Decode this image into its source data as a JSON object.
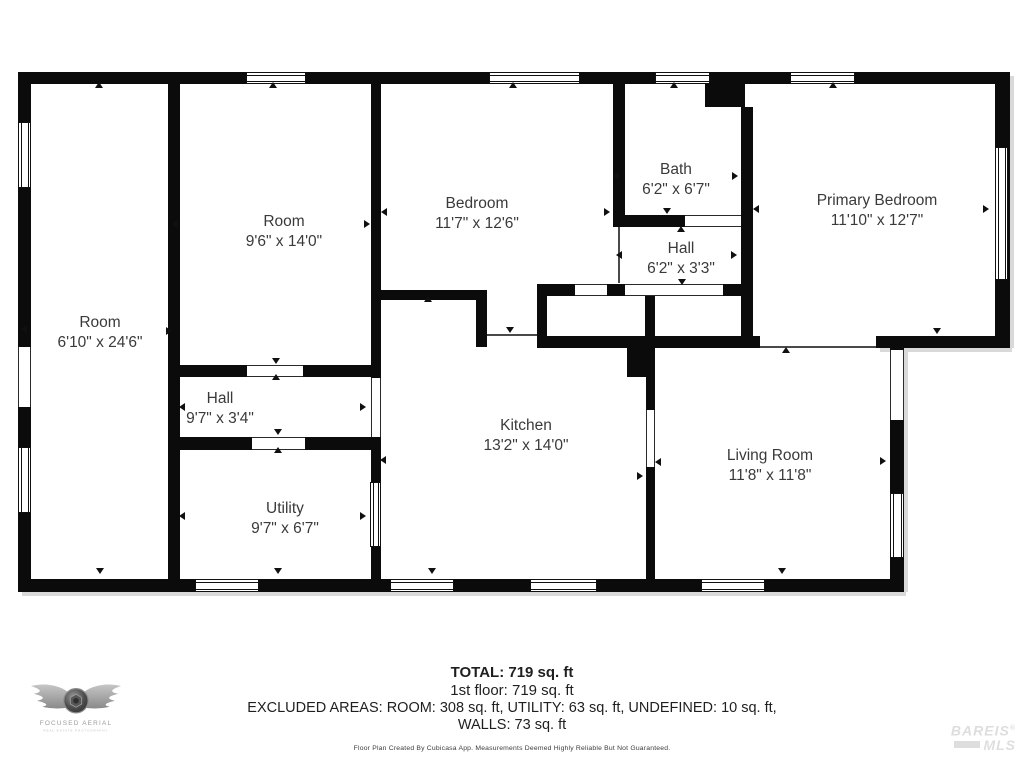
{
  "rooms": [
    {
      "name": "Room",
      "dims": "6'10\" x 24'6\""
    },
    {
      "name": "Room",
      "dims": "9'6\" x 14'0\""
    },
    {
      "name": "Bedroom",
      "dims": "11'7\" x 12'6\""
    },
    {
      "name": "Bath",
      "dims": "6'2\" x 6'7\""
    },
    {
      "name": "Hall",
      "dims": "6'2\" x 3'3\""
    },
    {
      "name": "Primary Bedroom",
      "dims": "11'10\" x 12'7\""
    },
    {
      "name": "Hall",
      "dims": "9'7\" x 3'4\""
    },
    {
      "name": "Utility",
      "dims": "9'7\" x 6'7\""
    },
    {
      "name": "Kitchen",
      "dims": "13'2\" x 14'0\""
    },
    {
      "name": "Living Room",
      "dims": "11'8\" x 11'8\""
    }
  ],
  "summary": {
    "total": "TOTAL: 719 sq. ft",
    "floor": "1st floor: 719 sq. ft",
    "excluded": "EXCLUDED AREAS: ROOM: 308 sq. ft, UTILITY: 63 sq. ft, UNDEFINED: 10 sq. ft,",
    "walls": "WALLS: 73 sq. ft"
  },
  "disclaimer": "Floor Plan Created By Cubicasa App. Measurements Deemed Highly Reliable But Not Guaranteed.",
  "logo": {
    "name": "FOCUSED AERIAL",
    "tagline": "REAL ESTATE PHOTOGRAPHY"
  },
  "watermark": {
    "line1": "BAREIS",
    "reg": "®",
    "line2": "MLS"
  },
  "colors": {
    "wall": "#0b0b0b",
    "label_text": "#3a3a3a",
    "summary_text": "#1f1f1f",
    "watermark": "#dedede"
  }
}
